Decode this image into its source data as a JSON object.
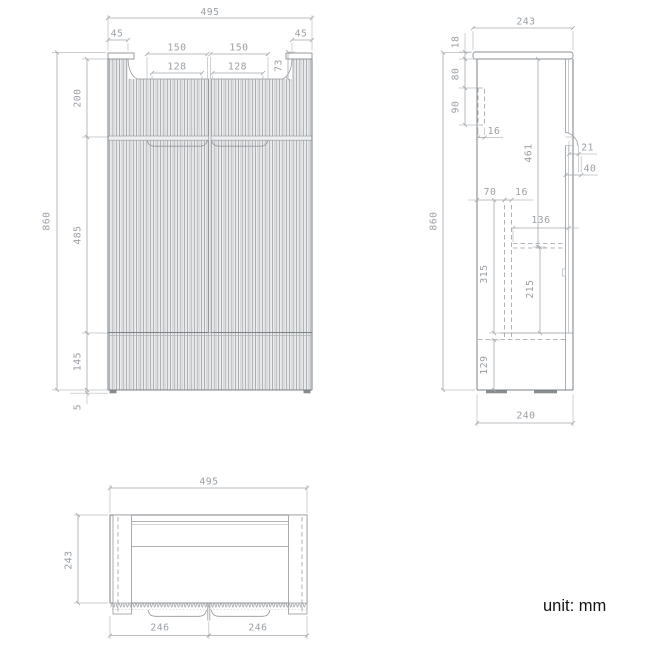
{
  "footer": {
    "unit_label": "unit: mm"
  },
  "views": {
    "front": {
      "dims": {
        "overall_width": "495",
        "left_post_width": "45",
        "right_post_width": "45",
        "left_handle_width": "150",
        "right_handle_width": "150",
        "left_handle_inner": "128",
        "right_handle_inner": "128",
        "top_recess_depth": "73",
        "upper_section_height": "200",
        "overall_height": "860",
        "door_section_height": "485",
        "drawer_section_height": "145",
        "foot_height": "5"
      }
    },
    "side": {
      "dims": {
        "overall_depth": "243",
        "top_panel_thickness": "18",
        "bracket_offset": "80",
        "bracket_height": "90",
        "bracket_width": "16",
        "interior_height": "461",
        "handle_depth": "21",
        "handle_clearance": "40",
        "back_offset": "70",
        "panel_gap": "16",
        "shelf_depth": "136",
        "overall_height": "860",
        "lower_interior_height": "315",
        "shelf_clearance": "215",
        "drawer_interior_height": "129",
        "bottom_depth": "240"
      }
    },
    "top": {
      "dims": {
        "overall_width": "495",
        "overall_depth": "243",
        "left_door_width": "246",
        "right_door_width": "246"
      }
    }
  }
}
